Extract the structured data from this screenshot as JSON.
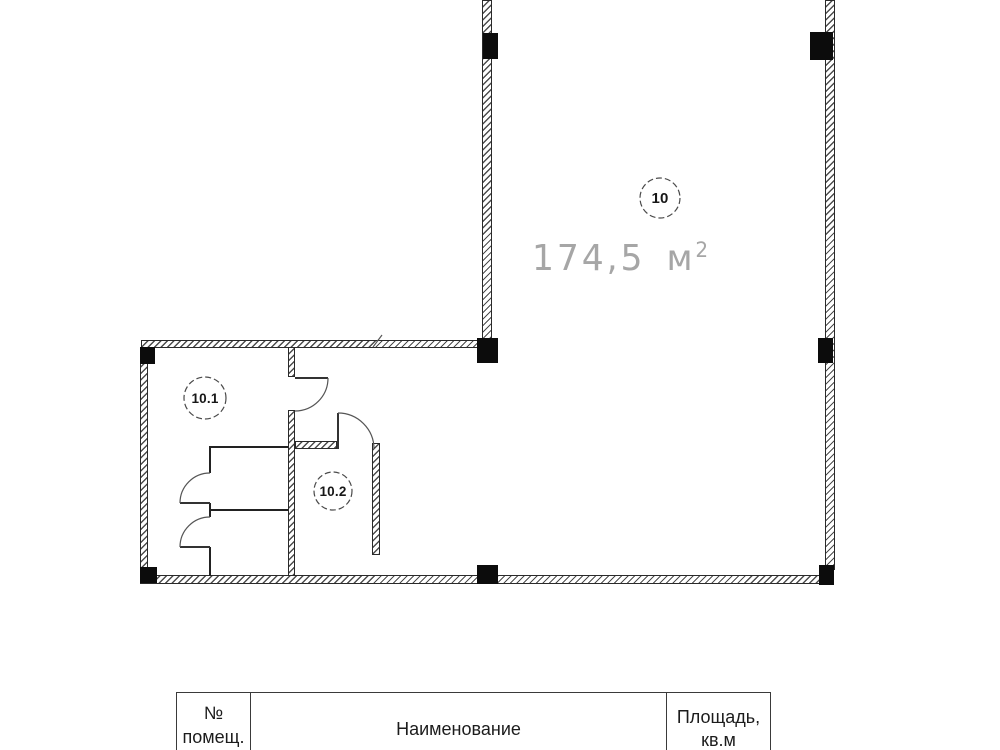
{
  "plan": {
    "room_main": {
      "number": "10",
      "area_value": "174,5",
      "area_unit": "м",
      "area_exponent": "2"
    },
    "room_101": {
      "number": "10.1"
    },
    "room_102": {
      "number": "10.2"
    }
  },
  "table": {
    "col_number_line1": "№",
    "col_number_line2": "помещ.",
    "col_name": "Наименование",
    "col_area_line1": "Площадь,",
    "col_area_line2": "кв.м"
  },
  "colors": {
    "wall_line": "#2a2a2a",
    "column_fill": "#0c0c0c",
    "area_label": "#a6a6a6",
    "table_border": "#3a3a3a"
  }
}
